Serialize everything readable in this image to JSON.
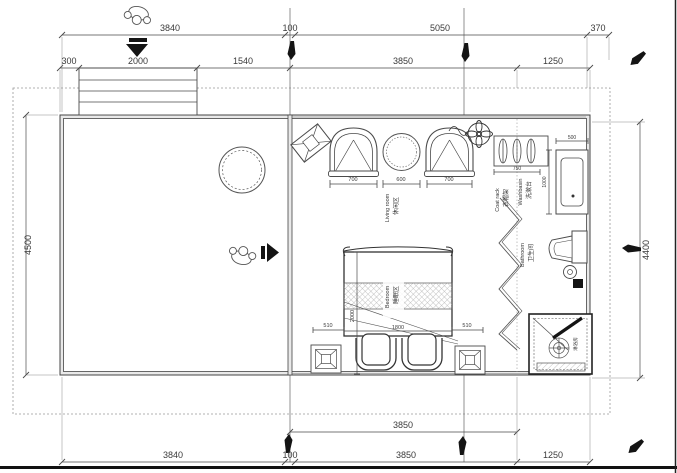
{
  "drawing": {
    "type": "floor-plan",
    "units": "mm"
  },
  "colors": {
    "line": "#4a4a4a",
    "wall_fill": "#e9e9e9",
    "dim_text": "#3a3a3a",
    "dashed_boundary": "#999999",
    "marker_black": "#141414",
    "background": "#ffffff"
  },
  "dims": {
    "top1": [
      "3840",
      "100",
      "5050",
      "370"
    ],
    "top2": [
      "300",
      "2000",
      "1540",
      "3850",
      "1250"
    ],
    "left": "4500",
    "right": "4400",
    "living": [
      "700",
      "600",
      "700"
    ],
    "coat_rack": "750",
    "washbasin_w": "500",
    "washbasin_d": "1000",
    "bed": {
      "left": "510",
      "width": "1800",
      "right": "510",
      "length": "2000"
    },
    "bottom_inner": [
      "3850"
    ],
    "bottom": [
      "3840",
      "100",
      "3850",
      "1250"
    ]
  },
  "rooms": {
    "living": {
      "zh": "休闲区",
      "en": "Living room"
    },
    "bedroom": {
      "zh": "睡眠区",
      "en": "Bedroom"
    },
    "bathroom": {
      "zh": "卫生间",
      "en": "Bathroom"
    },
    "washbasin": {
      "zh": "洗漱台",
      "en": "Washbasin"
    },
    "coat_rack": {
      "zh": "衣帽架",
      "en": "Coat rack"
    },
    "shower": {
      "zh": "淋浴房"
    }
  }
}
